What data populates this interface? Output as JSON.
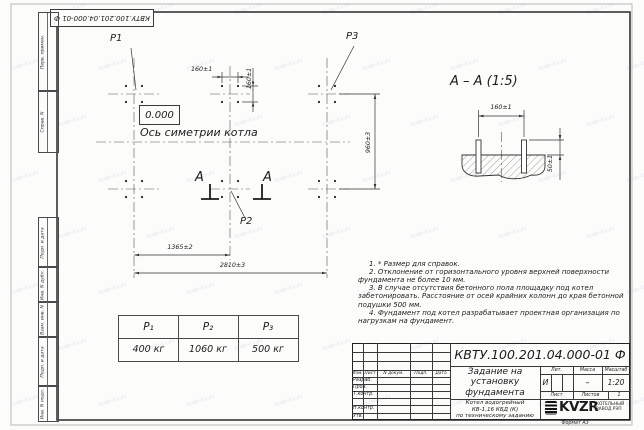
{
  "page": {
    "stamp_top": "КВТУ.100.201.04.000-01 Ф",
    "format": "Формат А3"
  },
  "watermark": "kotel-kv.kz",
  "frame_left": {
    "top_labels": [
      "Перв. примен.",
      "Справ. N"
    ],
    "bottom_labels": [
      "Подп. и дата",
      "Инв. N дубл.",
      "Взам. инв. N",
      "Подп. и дата",
      "Инв. N подл."
    ]
  },
  "plan": {
    "p1": "P1",
    "p2": "P2",
    "p3": "P3",
    "elevation": "0.000",
    "axis_label": "Ось симетрии котла",
    "section_letter": "А",
    "dims": {
      "h160": "160±1",
      "v160": "160±1",
      "v960": "960±3",
      "w1365": "1365±2",
      "w2810": "2810±3"
    }
  },
  "section": {
    "title": "А – А (1:5)",
    "dim160": "160±1",
    "dim50": "50±1"
  },
  "loads_table": {
    "headers": [
      "P₁",
      "P₂",
      "P₃"
    ],
    "values": [
      "400 кг",
      "1060 кг",
      "500 кг"
    ]
  },
  "notes": [
    "1. * Размер для справок.",
    "2. Отклонение от горизонтального уровня верхней поверхности фундамента не более 10 мм.",
    "3. В случае отсутствия бетонного пола площадку под котел забетонировать. Расстояние от осей крайних колонн до края бетонной подушки 500 мм.",
    "4. Фундамент под котел разрабатывает проектная организация по нагрузкам на фундамент."
  ],
  "title_block": {
    "doc_number": "КВТУ.100.201.04.000-01 Ф",
    "title": "Задание на установку фундамента",
    "subtitle_lines": [
      "Котел водогрейный",
      "КВ-1,16 КБД (К)",
      "по техническому заданию"
    ],
    "header_cells": [
      "Изм.",
      "Лист",
      "N докум.",
      "Подп.",
      "Дата"
    ],
    "row_labels": [
      "Разраб.",
      "Пров.",
      "Т.контр.",
      "Н.контр.",
      "Утв."
    ],
    "lit_header": "Лит.",
    "mass_header": "Масса",
    "scale_header": "Масштаб",
    "lit_value": "И",
    "mass_value": "–",
    "scale_value": "1:20",
    "sheet_label": "Лист",
    "sheets_label": "Листов",
    "sheets_value": "1",
    "logo_text": "KVZR",
    "logo_caption": "КОТЕЛЬНЫЙ ЗАВОД РЭП"
  }
}
